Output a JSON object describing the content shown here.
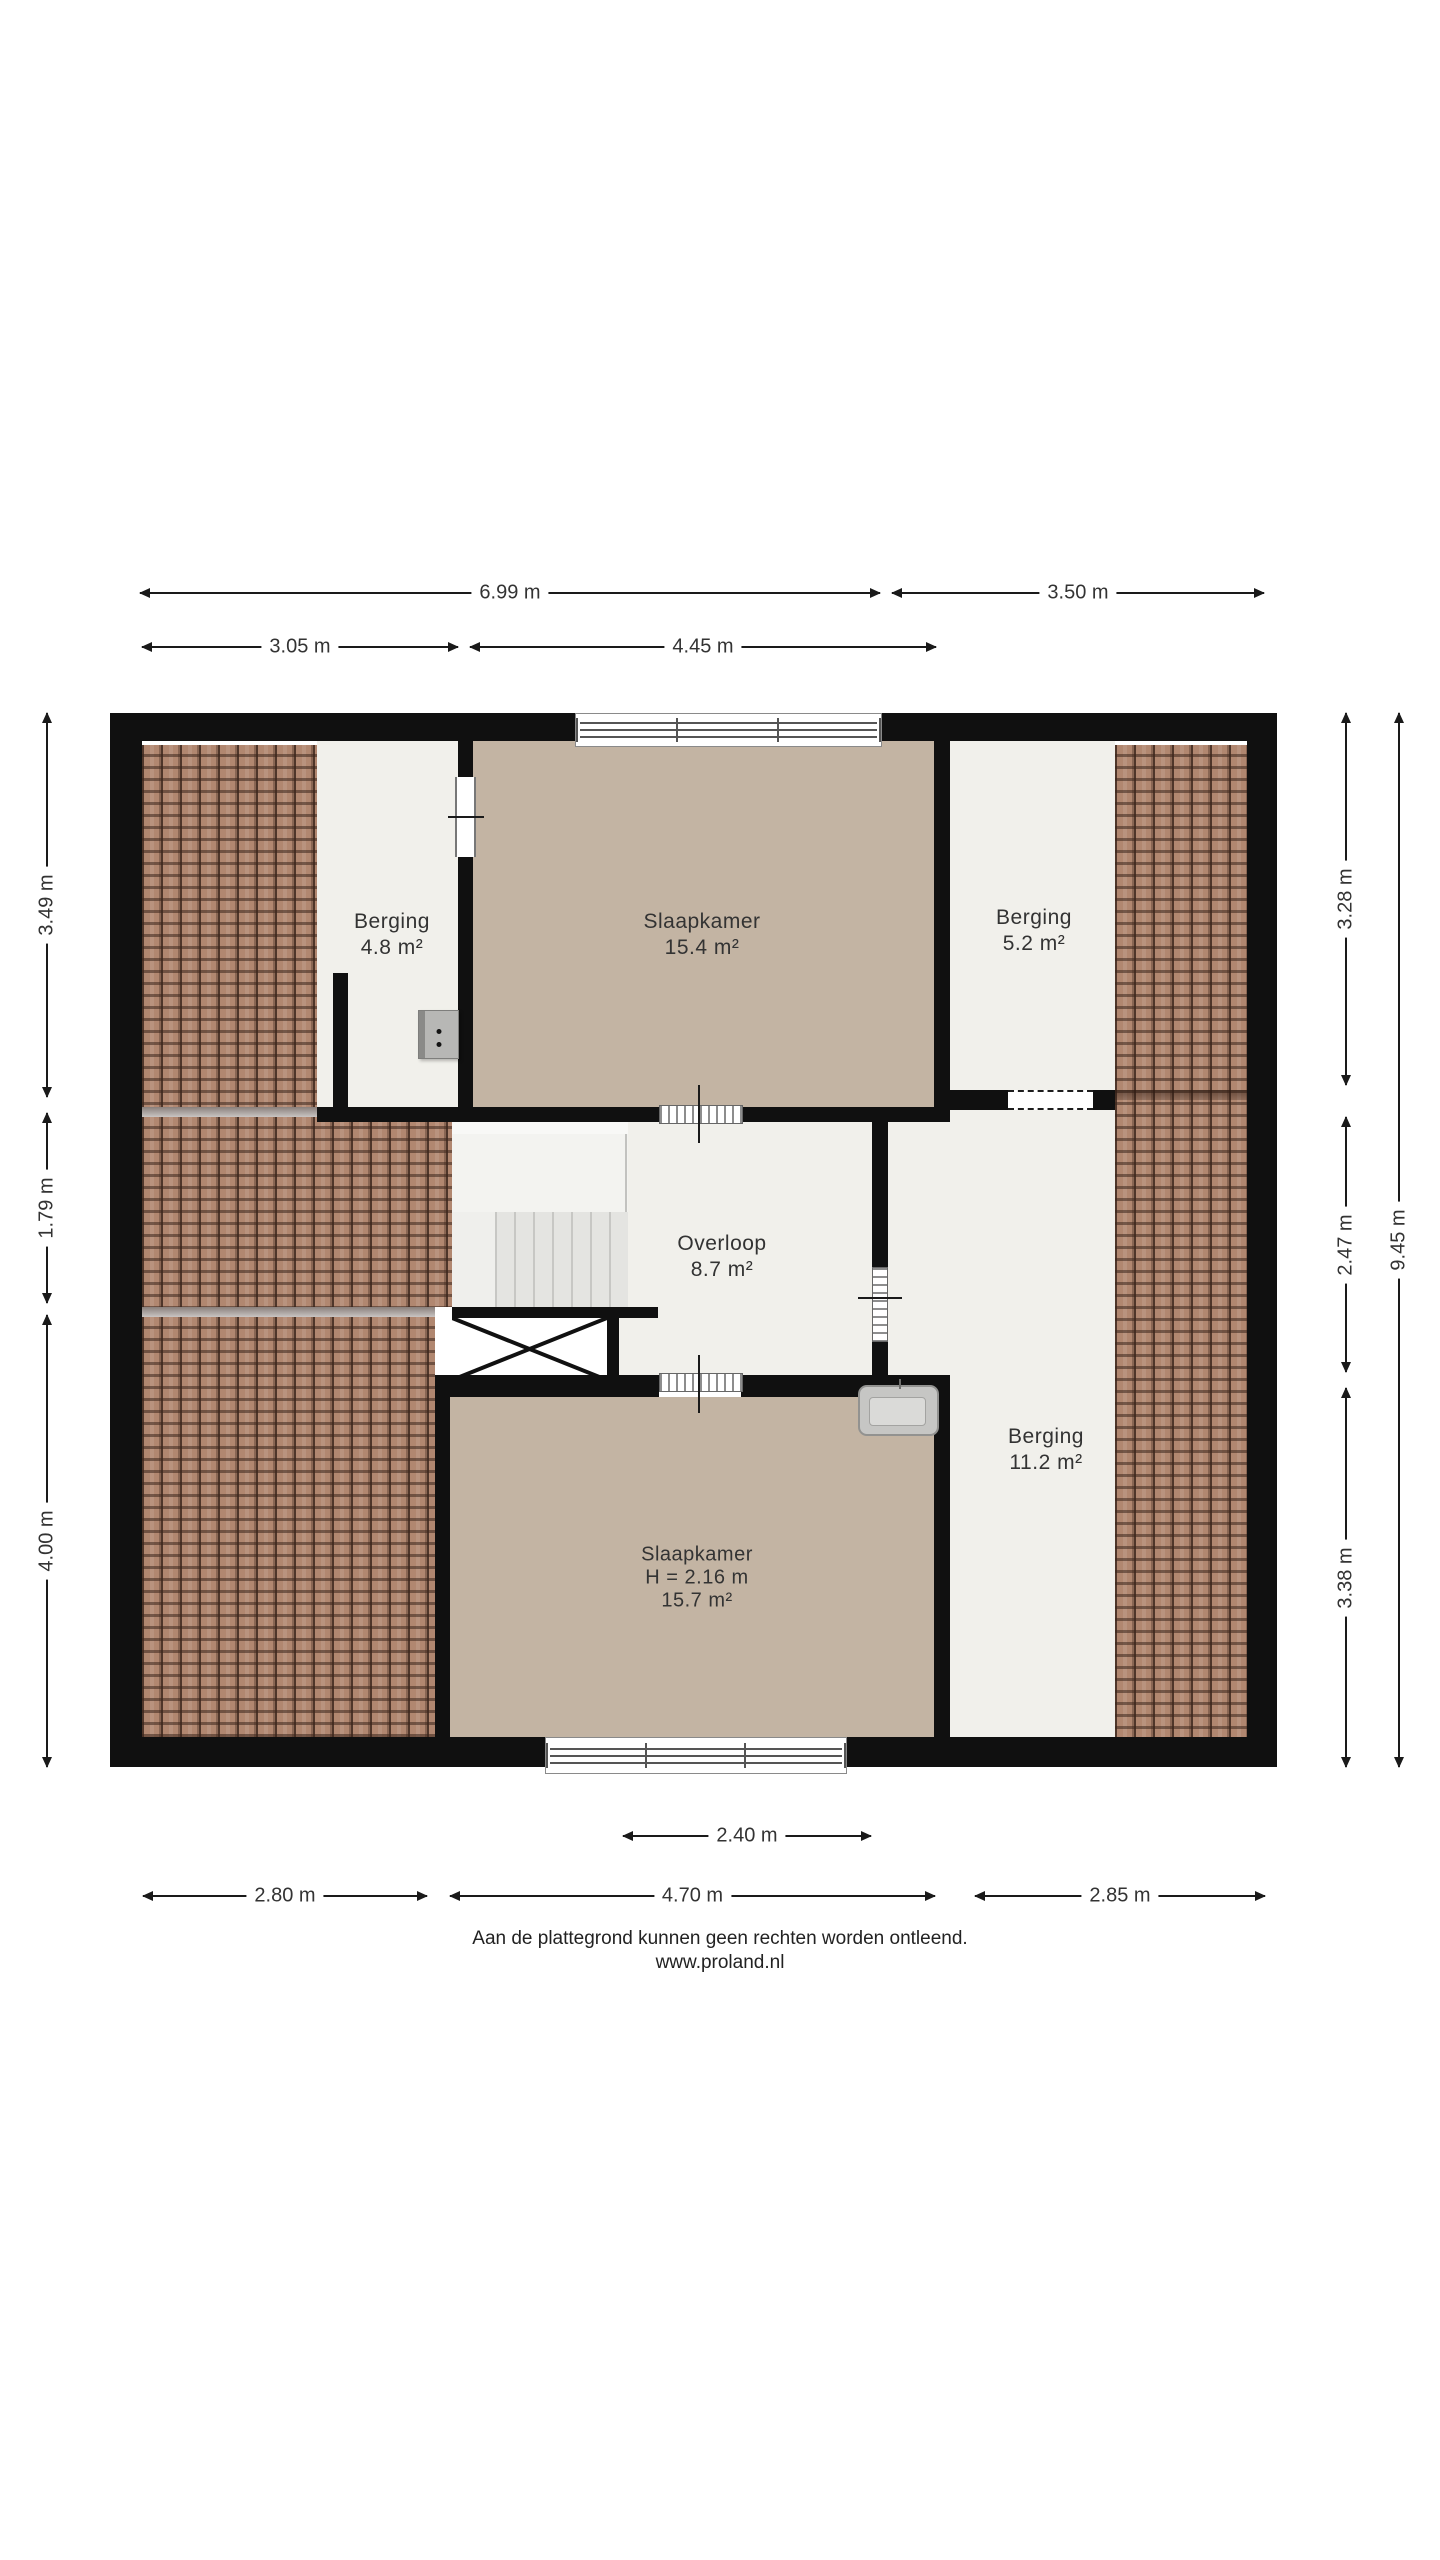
{
  "rooms": {
    "berging_tl": {
      "name": "Berging",
      "area": "4.8 m²"
    },
    "slaapkamer_top": {
      "name": "Slaapkamer",
      "area": "15.4 m²"
    },
    "berging_tr": {
      "name": "Berging",
      "area": "5.2 m²"
    },
    "overloop": {
      "name": "Overloop",
      "area": "8.7 m²"
    },
    "berging_right": {
      "name": "Berging",
      "area": "11.2 m²"
    },
    "slaapkamer_bottom": {
      "name": "Slaapkamer",
      "height_note": "H = 2.16 m",
      "area": "15.7 m²"
    }
  },
  "dims": {
    "top_outer_left": "6.99 m",
    "top_outer_right": "3.50 m",
    "top_inner_left": "3.05 m",
    "top_inner_right": "4.45 m",
    "bottom_window": "2.40 m",
    "bottom_left": "2.80 m",
    "bottom_center": "4.70 m",
    "bottom_right": "2.85 m",
    "left_top": "3.49 m",
    "left_mid": "1.79 m",
    "left_bottom": "4.00 m",
    "right_top": "3.28 m",
    "right_mid": "2.47 m",
    "right_bottom": "3.38 m",
    "right_total": "9.45 m"
  },
  "footer": {
    "disclaimer": "Aan de plattegrond kunnen geen rechten worden ontleend.",
    "website": "www.proland.nl"
  },
  "colors": {
    "wall": "#101010",
    "room-beige": "#c3b4a3",
    "room-white": "#f1f0eb",
    "tile-base": "#b18770",
    "dim-text": "#333333"
  }
}
